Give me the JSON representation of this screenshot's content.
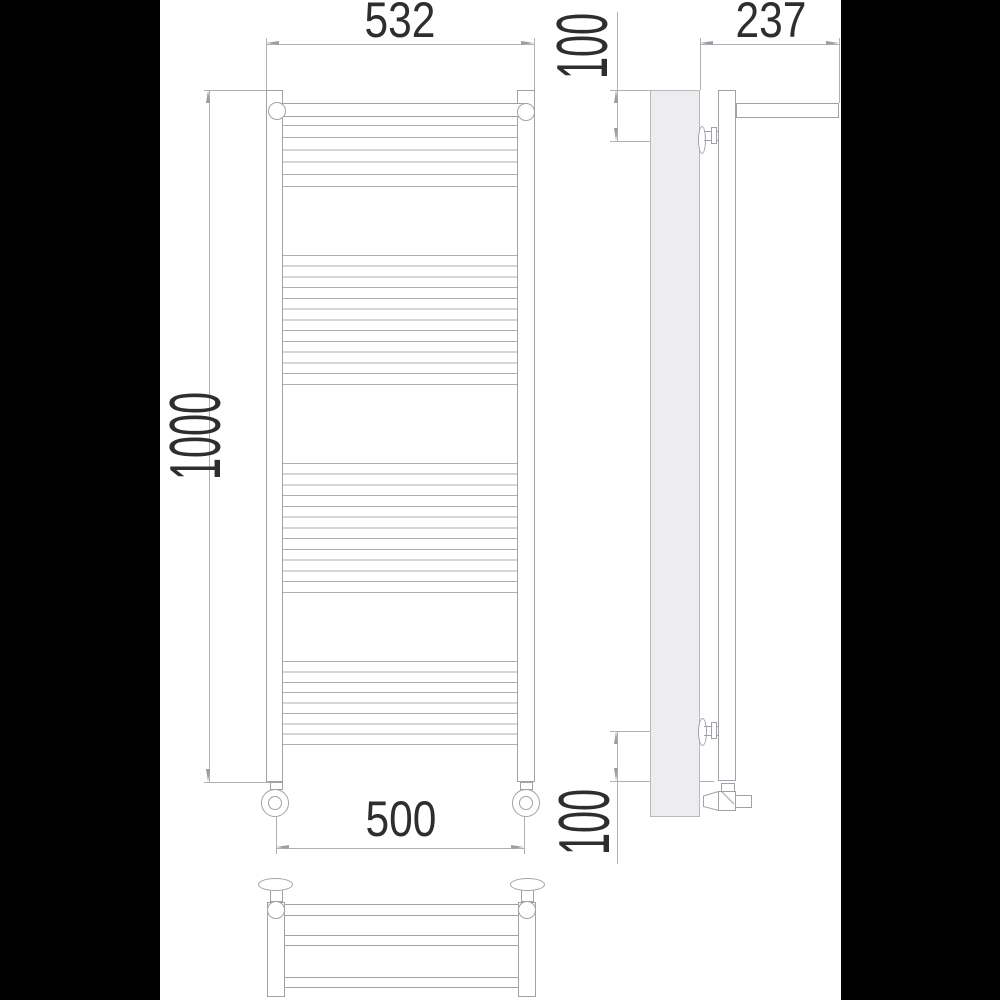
{
  "document": {
    "type": "technical-drawing",
    "subject": "ladder towel radiator with shelf",
    "views": [
      "front",
      "side",
      "top"
    ]
  },
  "dimensions": {
    "top_width": "532",
    "shelf_depth": "237",
    "top_offset": "100",
    "height": "1000",
    "pipe_spacing": "500",
    "bottom_offset": "100"
  },
  "colors": {
    "background": "#000000",
    "sheet": "#ffffff",
    "object_line": "#9fa3a7",
    "dimension_line": "#aeb2b6",
    "wall_fill": "#ededef",
    "text": "#2e2e30"
  },
  "drawing": {
    "front_view": {
      "rung_line_color": "#aeaeb2",
      "rung_groups": [
        {
          "lines": 6,
          "from_y": 125,
          "to_y": 186
        },
        {
          "lines": 13,
          "from_y": 255,
          "to_y": 384
        },
        {
          "lines": 13,
          "from_y": 463,
          "to_y": 592
        },
        {
          "lines": 9,
          "from_y": 661,
          "to_y": 744
        }
      ]
    }
  }
}
